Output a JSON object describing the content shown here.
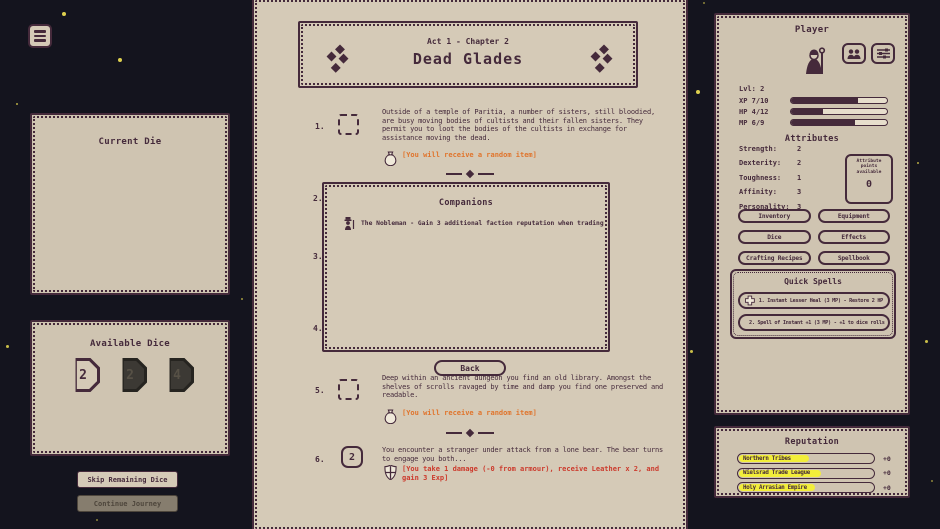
{
  "left": {
    "current_die_title": "Current Die",
    "available_dice_title": "Available Dice",
    "dice": [
      {
        "value": "2",
        "state": "active"
      },
      {
        "value": "2",
        "state": "used"
      },
      {
        "value": "4",
        "state": "used"
      }
    ],
    "skip_label": "Skip Remaining Dice",
    "continue_label": "Continue Journey"
  },
  "chapter": {
    "act": "Act 1 - Chapter 2",
    "title": "Dead Glades",
    "numbers": [
      "1.",
      "2.",
      "3.",
      "4.",
      "5.",
      "6."
    ],
    "item1": {
      "text": "Outside of a temple of Paritia, a number of sisters, still bloodied, are busy moving bodies of cultists and their fallen sisters. They permit you to loot the bodies of the cultists in exchange for assistance moving the dead.",
      "reward": "[You will receive a random item]"
    },
    "companions": {
      "title": "Companions",
      "entry": "The Nobleman - Gain 3 additional faction reputation when trading"
    },
    "back_label": "Back",
    "item5": {
      "text": "Deep within an ancient dungeon you find an old library. Amongst the shelves of scrolls ravaged by time and damp you find one preserved and readable.",
      "reward": "[You will receive a random item]"
    },
    "item6": {
      "die": "2",
      "text": "You encounter a stranger under attack from a lone bear. The bear turns to engage you both...",
      "result": "[You take 1 damage (-0 from armour), receive Leather x 2, and gain 3 Exp]"
    }
  },
  "player": {
    "title": "Player",
    "level": "Lvl: 2",
    "xp": {
      "label": "XP 7/10",
      "pct": 70
    },
    "hp": {
      "label": "HP 4/12",
      "pct": 33
    },
    "mp": {
      "label": "MP 6/9",
      "pct": 67
    },
    "attributes": {
      "title": "Attributes",
      "rows": [
        {
          "name": "Strength:",
          "value": "2"
        },
        {
          "name": "Dexterity:",
          "value": "2"
        },
        {
          "name": "Toughness:",
          "value": "1"
        },
        {
          "name": "Affinity:",
          "value": "3"
        },
        {
          "name": "Personality:",
          "value": "3"
        }
      ],
      "points_label": "Attribute points available",
      "points_value": "0"
    },
    "buttons": [
      "Inventory",
      "Equipment",
      "Dice",
      "Effects",
      "Crafting Recipes",
      "Spellbook"
    ],
    "quick_spells": {
      "title": "Quick Spells",
      "spells": [
        "1. Instant Lesser Heal (3 MP) - Restore 2 HP",
        "2. Spell of Instant +1 (3 MP) - +1 to dice rolls"
      ]
    }
  },
  "reputation": {
    "title": "Reputation",
    "rows": [
      {
        "name": "Northern Tribes",
        "value": "+0"
      },
      {
        "name": "Wielsrad Trade League",
        "value": "+0"
      },
      {
        "name": "Holy Arrasian Empire",
        "value": "+0"
      }
    ]
  },
  "colors": {
    "background": "#14141e",
    "parchment": "#d5cab7",
    "ink": "#452a3b",
    "reward_orange": "#e0742c",
    "damage_red": "#cc3a2c",
    "reputation_yellow": "#f2ee3a"
  }
}
